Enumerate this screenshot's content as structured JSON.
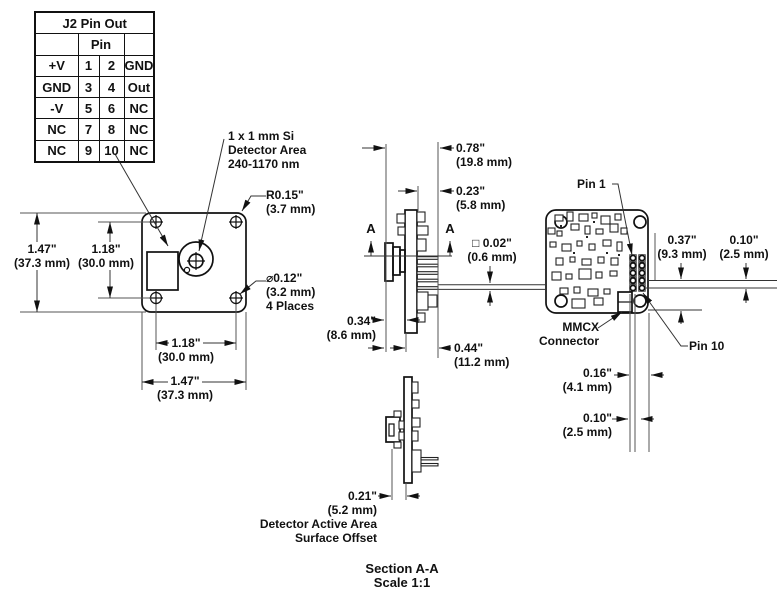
{
  "pin_table": {
    "title": "J2 Pin Out",
    "pin_header": "Pin",
    "rows": [
      {
        "left": "+V",
        "p1": "1",
        "p2": "2",
        "right": "GND"
      },
      {
        "left": "GND",
        "p1": "3",
        "p2": "4",
        "right": "Out"
      },
      {
        "left": "-V",
        "p1": "5",
        "p2": "6",
        "right": "NC"
      },
      {
        "left": "NC",
        "p1": "7",
        "p2": "8",
        "right": "NC"
      },
      {
        "left": "NC",
        "p1": "9",
        "p2": "10",
        "right": "NC"
      }
    ]
  },
  "front_view": {
    "detector_note": {
      "line1": "1 x 1 mm Si",
      "line2": "Detector Area",
      "line3": "240-1170 nm"
    },
    "corner_radius": {
      "in": "R0.15\"",
      "mm": "(3.7 mm)"
    },
    "hole_dia": {
      "in": "⌀12\" dia",
      "label_in": "⌀0.12\"",
      "mm": "(3.2 mm)",
      "note": "4 Places"
    },
    "height": {
      "in": "1.47\"",
      "mm": "(37.3 mm)"
    },
    "hole_spacing_v": {
      "in": "1.18\"",
      "mm": "(30.0 mm)"
    },
    "hole_spacing_h": {
      "in": "1.18\"",
      "mm": "(30.0 mm)"
    },
    "width": {
      "in": "1.47\"",
      "mm": "(37.3 mm)"
    }
  },
  "side_view": {
    "overall_depth": {
      "in": "0.78\"",
      "mm": "(19.8 mm)"
    },
    "pin_protrusion": {
      "in": "0.23\"",
      "mm": "(5.8 mm)"
    },
    "pin_square": {
      "in": "□ 0.02\"",
      "mm": "(0.6 mm)"
    },
    "can_depth": {
      "in": "0.34\"",
      "mm": "(8.6 mm)"
    },
    "board_to_pin": {
      "in": "0.44\"",
      "mm": "(11.2 mm)"
    },
    "section_letter": "A"
  },
  "back_view": {
    "pin1_label": "Pin 1",
    "pin10_label": "Pin 10",
    "mmcx": {
      "line1": "MMCX",
      "line2": "Connector"
    },
    "dim_row_offset": {
      "in": "0.37\"",
      "mm": "(9.3 mm)"
    },
    "dim_row_pitch": {
      "in": "0.10\"",
      "mm": "(2.5 mm)"
    },
    "dim_col_offset": {
      "in": "0.16\"",
      "mm": "(4.1 mm)"
    },
    "dim_col_pitch": {
      "in": "0.10\"",
      "mm": "(2.5 mm)"
    }
  },
  "section_view": {
    "offset": {
      "in": "0.21\"",
      "mm": "(5.2 mm)"
    },
    "offset_note1": "Detector Active Area",
    "offset_note2": "Surface Offset",
    "caption1": "Section A-A",
    "caption2": "Scale 1:1"
  }
}
